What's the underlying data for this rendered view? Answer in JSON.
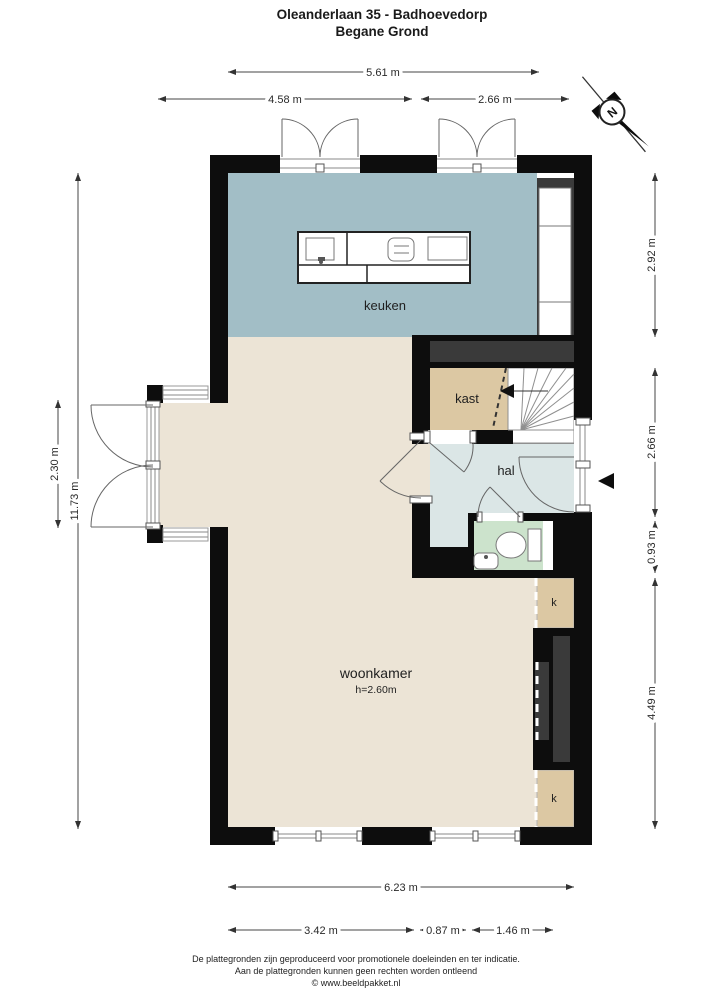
{
  "title": {
    "line1": "Oleanderlaan 35 - Badhoevedorp",
    "line2": "Begane Grond"
  },
  "compass": {
    "label": "N"
  },
  "rooms": {
    "keuken": {
      "label": "keuken"
    },
    "kast": {
      "label": "kast"
    },
    "hal": {
      "label": "hal"
    },
    "woonkamer": {
      "label": "woonkamer",
      "height_note": "h=2.60m"
    },
    "closet1": {
      "label": "k"
    },
    "closet2": {
      "label": "k"
    }
  },
  "dimensions": {
    "top": [
      {
        "label": "5.61 m"
      },
      {
        "label": "4.58 m"
      },
      {
        "label": "2.66 m"
      }
    ],
    "left": [
      {
        "label": "11.73 m"
      },
      {
        "label": "2.30 m"
      }
    ],
    "right": [
      {
        "label": "2.92 m"
      },
      {
        "label": "2.66 m"
      },
      {
        "label": "0.93 m"
      },
      {
        "label": "4.49 m"
      }
    ],
    "bottom": [
      {
        "label": "6.23 m"
      },
      {
        "label": "3.42 m"
      },
      {
        "label": "0.87 m"
      },
      {
        "label": "1.46 m"
      }
    ]
  },
  "footer": {
    "line1": "De plattegronden zijn geproduceerd voor promotionele doeleinden en ter indicatie.",
    "line2": "Aan de plattegronden kunnen geen rechten worden ontleend",
    "line3": "© www.beeldpakket.nl"
  },
  "colors": {
    "keuken_floor": "#a2bec6",
    "woonkamer_floor": "#ece4d6",
    "kast_floor": "#dcc8a3",
    "hal_floor": "#dbe6e6",
    "toilet_floor": "#cce3cc",
    "wall": "#0d0d0d",
    "dark_fixture": "#3a3a3a"
  }
}
